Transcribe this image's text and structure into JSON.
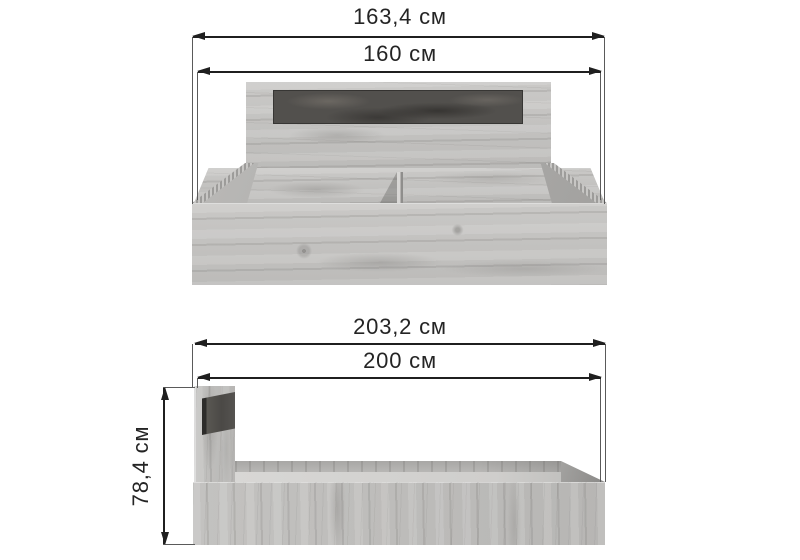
{
  "front_view": {
    "outer_width": "163,4 см",
    "inner_width": "160 см"
  },
  "side_view": {
    "outer_length": "203,2 см",
    "inner_length": "200 см",
    "height": "78,4 см"
  },
  "colors": {
    "background": "#ffffff",
    "dimension_line": "#1f1f1f",
    "extension_line": "#5a5a5a",
    "label_text": "#242424",
    "wood_light": "#c6c5c3",
    "wood_mid": "#b3b2b0",
    "accent_panel_dark": "#52504d",
    "platform_highlight": "#d6d5d3"
  }
}
